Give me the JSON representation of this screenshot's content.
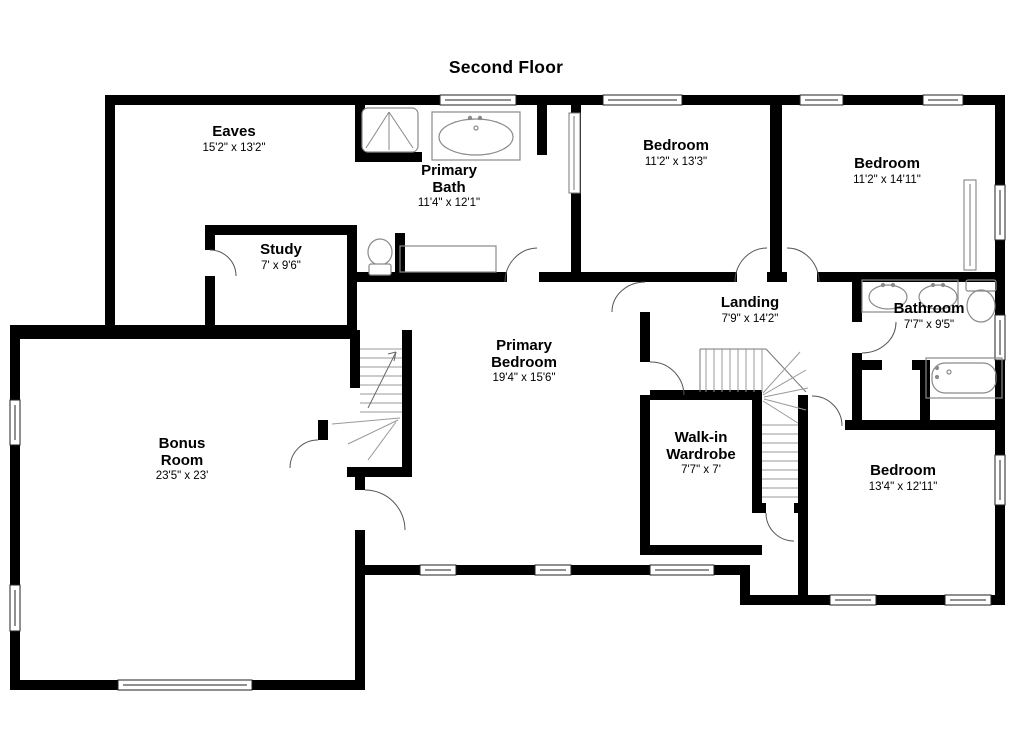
{
  "title": "Second Floor",
  "plan": {
    "rooms": [
      {
        "id": "eaves",
        "name": "Eaves",
        "dims": "15'2\" x 13'2\""
      },
      {
        "id": "primary-bath",
        "name": "Primary\nBath",
        "dims": "11'4\" x 12'1\""
      },
      {
        "id": "bedroom-1",
        "name": "Bedroom",
        "dims": "11'2\" x 13'3\""
      },
      {
        "id": "bedroom-2",
        "name": "Bedroom",
        "dims": "11'2\" x 14'11\""
      },
      {
        "id": "study",
        "name": "Study",
        "dims": "7' x 9'6\""
      },
      {
        "id": "landing",
        "name": "Landing",
        "dims": "7'9\" x 14'2\""
      },
      {
        "id": "bathroom",
        "name": "Bathroom",
        "dims": "7'7\" x 9'5\""
      },
      {
        "id": "primary-bedroom",
        "name": "Primary\nBedroom",
        "dims": "19'4\" x 15'6\""
      },
      {
        "id": "walk-in-wardrobe",
        "name": "Walk-in\nWardrobe",
        "dims": "7'7\" x 7'"
      },
      {
        "id": "bonus-room",
        "name": "Bonus\nRoom",
        "dims": "23'5\" x 23'"
      },
      {
        "id": "bedroom-3",
        "name": "Bedroom",
        "dims": "13'4\" x 12'11\""
      }
    ],
    "fixtures": [
      {
        "id": "shower",
        "room": "Primary Bath"
      },
      {
        "id": "bathtub",
        "room": "Primary Bath"
      },
      {
        "id": "toilet",
        "room": "Primary Bath"
      },
      {
        "id": "vanity-counter",
        "room": "Primary Bath"
      },
      {
        "id": "double-sink-vanity",
        "room": "Bathroom"
      },
      {
        "id": "toilet",
        "room": "Bathroom"
      },
      {
        "id": "bathtub",
        "room": "Bathroom"
      },
      {
        "id": "main-staircase",
        "room": "Landing"
      },
      {
        "id": "rear-staircase",
        "room": "Bonus Room"
      }
    ],
    "colors": {
      "wall": "#000000",
      "fixture_line": "#8a8a8a",
      "door_arc": "#555555",
      "background": "#ffffff"
    }
  }
}
